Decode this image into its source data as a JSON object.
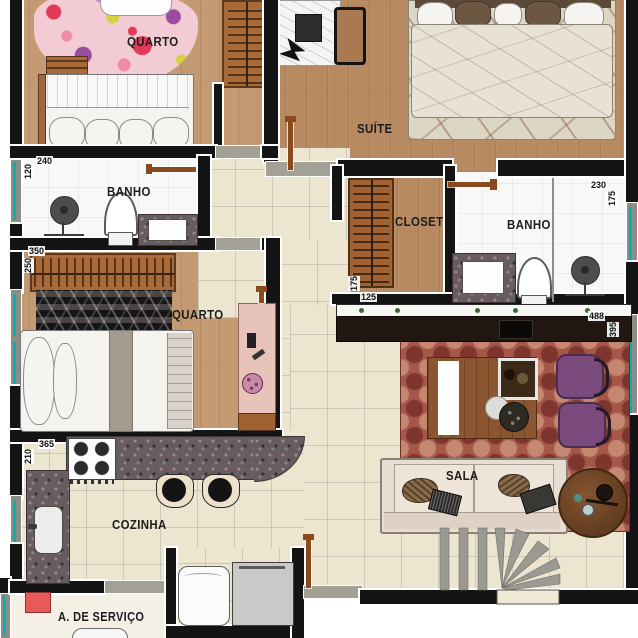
{
  "plan": {
    "type": "apartment-floor-plan",
    "rooms": {
      "quarto1": {
        "label": "QUARTO"
      },
      "suite": {
        "label": "SUÍTE"
      },
      "banho1": {
        "label": "BANHO"
      },
      "closet": {
        "label": "CLOSET"
      },
      "banho2": {
        "label": "BANHO"
      },
      "quarto2": {
        "label": "QUARTO"
      },
      "sala": {
        "label": "SALA"
      },
      "cozinha": {
        "label": "COZINHA"
      },
      "servico": {
        "label": "A. DE SERVIÇO"
      }
    },
    "dims": {
      "banho1_w": "240",
      "banho1_h": "120",
      "quarto2_w": "350",
      "quarto2_h": "250",
      "closet_h": "175",
      "closet_w": "125",
      "banho2_w": "230",
      "banho2_h": "175",
      "sala_w": "488",
      "sala_h": "395",
      "cozinha_w": "365",
      "cozinha_h": "210"
    }
  },
  "colors": {
    "wall": "#141414",
    "outline": "#ffffff",
    "tile": "#ece6d1",
    "bath": "#f8f8f8",
    "wood": "#b78a62",
    "wood_light": "#c49a72",
    "window": "#00b4b6",
    "wall_gray": "#8e8d85",
    "threshold": "#a3a096",
    "granite": "#675d61",
    "door": "#8a4a1e",
    "rug_pink": "#f2cbd4",
    "rug_suite": "#dcd6c5",
    "rug_dark": "#262222",
    "rug_sala": "#a5574a",
    "rug_sala_dark": "#7d352d",
    "rug_sala_light": "#c4876f",
    "sofa": "#e7ddd2",
    "purple": "#7b4a7d",
    "table_wood": "#8a552f",
    "round_table": "#6f4627",
    "bar": "#211710",
    "stool_cream": "#ede1cb",
    "closet_wood": "#a06233",
    "red_item": "#e8595a",
    "stair_gray": "#9b9a92"
  }
}
